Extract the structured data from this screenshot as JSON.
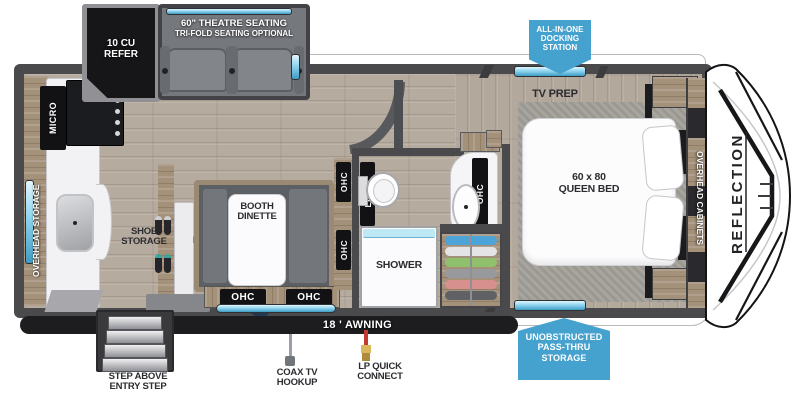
{
  "colors": {
    "badge_blue": "#45a1ce",
    "window_blue": "#8fd4ef",
    "wall_gray": "#4a4a4d",
    "wood_tan": "#a3917a",
    "floor_tan": "#b6ab9f"
  },
  "callouts": {
    "docking": [
      "ALL-IN-ONE",
      "DOCKING",
      "STATION"
    ],
    "passthru": [
      "UNOBSTRUCTED",
      "PASS-THRU",
      "STORAGE"
    ]
  },
  "exterior": {
    "awning": "18 ' AWNING",
    "step": [
      "STEP ABOVE",
      "ENTRY STEP"
    ],
    "coax": [
      "COAX TV",
      "HOOKUP"
    ],
    "lp": [
      "LP QUICK",
      "CONNECT"
    ],
    "brand": "REFLECTION"
  },
  "labels": {
    "refer": [
      "10 CU",
      "REFER"
    ],
    "theatre": [
      "60\" THEATRE SEATING",
      "TRI-FOLD SEATING OPTIONAL"
    ],
    "micro": "MICRO",
    "overhead_storage": "OVERHEAD STORAGE",
    "shoe": [
      "SHOE",
      "STORAGE"
    ],
    "ent": [
      "ENT. CENTER",
      "40\" LED TV"
    ],
    "dinette": [
      "BOOTH",
      "DINETTE"
    ],
    "ohc": "OHC",
    "linen": "LINEN",
    "shower": "SHOWER",
    "tv_prep": "TV PREP",
    "bed": [
      "60 x 80",
      "QUEEN BED"
    ],
    "overhead_cabinets": "OVERHEAD CABINETS"
  }
}
